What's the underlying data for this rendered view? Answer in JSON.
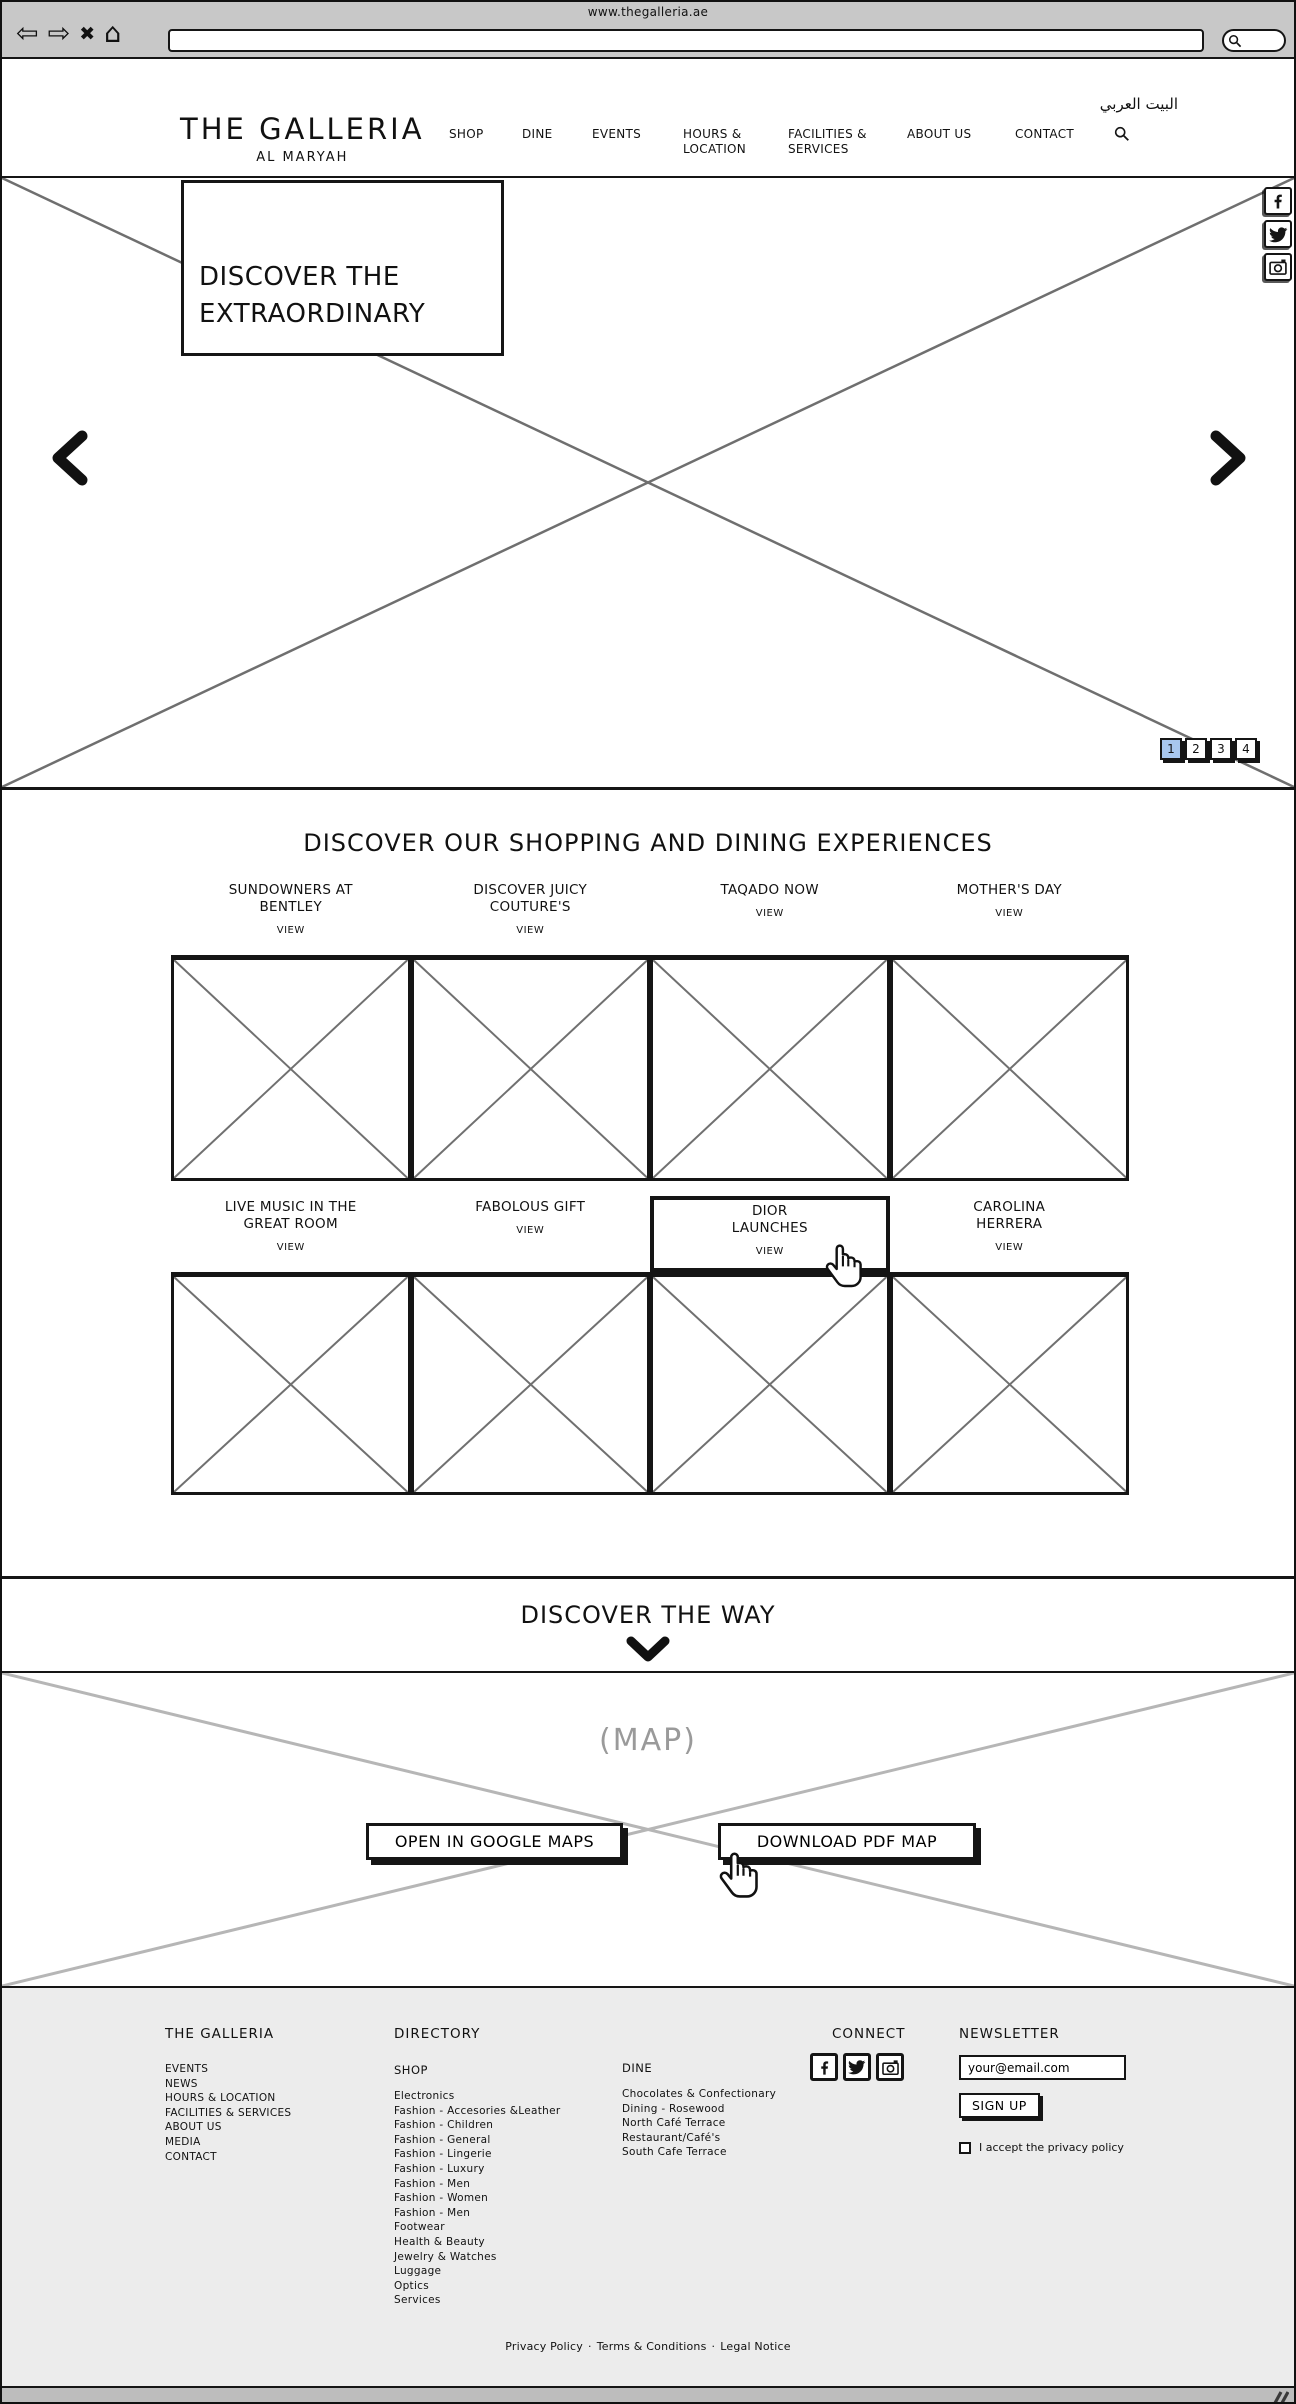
{
  "colors": {
    "wireframe_ink": "#151515",
    "chrome_bg": "#c8c8c8",
    "footer_bg": "#ececec",
    "active_page_bg": "#a8c7ee",
    "placeholder_line": "#6f6f6f",
    "map_line": "#b6b6b6",
    "map_label_gray": "#9a9a9a"
  },
  "browser": {
    "page_title": "www.thegalleria.ae",
    "url_value": "",
    "back_glyph": "⇦",
    "forward_glyph": "⇨",
    "close_glyph": "✖",
    "home_glyph": "⌂"
  },
  "header": {
    "logo": "THE GALLERIA",
    "logo_sub": "AL MARYAH",
    "language_link": "البيت العربي",
    "nav": [
      {
        "lines": [
          "SHOP"
        ]
      },
      {
        "lines": [
          "DINE"
        ]
      },
      {
        "lines": [
          "EVENTS"
        ]
      },
      {
        "lines": [
          "HOURS &",
          "LOCATION"
        ]
      },
      {
        "lines": [
          "FACILITIES &",
          "SERVICES"
        ]
      },
      {
        "lines": [
          "ABOUT US"
        ]
      },
      {
        "lines": [
          "CONTACT"
        ]
      }
    ]
  },
  "hero": {
    "headline_lines": [
      "DISCOVER THE",
      "EXTRAORDINARY"
    ],
    "pagination": [
      "1",
      "2",
      "3",
      "4"
    ],
    "active_page": "1"
  },
  "experiences": {
    "title": "DISCOVER OUR SHOPPING AND DINING EXPERIENCES",
    "view_label": "VIEW",
    "cards": [
      {
        "lines": [
          "SUNDOWNERS AT",
          "BENTLEY"
        ]
      },
      {
        "lines": [
          "DISCOVER JUICY",
          "COUTURE'S"
        ]
      },
      {
        "lines": [
          "TAQADO NOW",
          ""
        ]
      },
      {
        "lines": [
          "MOTHER'S DAY",
          ""
        ]
      },
      {
        "lines": [
          "LIVE MUSIC IN THE",
          "GREAT ROOM"
        ]
      },
      {
        "lines": [
          "FABOLOUS GIFT",
          ""
        ]
      },
      {
        "lines": [
          "DIOR",
          "LAUNCHES"
        ],
        "state": "hovered"
      },
      {
        "lines": [
          "CAROLINA",
          "HERRERA"
        ]
      }
    ]
  },
  "way": {
    "title": "DISCOVER THE WAY"
  },
  "map": {
    "placeholder_label": "(MAP)",
    "google_maps_button": "OPEN IN GOOGLE MAPS",
    "pdf_button": "DOWNLOAD PDF MAP"
  },
  "footer": {
    "galleria": {
      "heading": "THE GALLERIA",
      "links": [
        "EVENTS",
        "NEWS",
        "HOURS & LOCATION",
        "FACILITIES & SERVICES",
        "ABOUT US",
        "MEDIA",
        "CONTACT"
      ]
    },
    "directory": {
      "heading": "DIRECTORY",
      "shop": {
        "heading": "SHOP",
        "links": [
          "Electronics",
          "Fashion - Accesories &Leather",
          "Fashion - Children",
          "Fashion - General",
          "Fashion - Lingerie",
          "Fashion - Luxury",
          "Fashion - Men",
          "Fashion - Women",
          "Fashion - Men",
          "Footwear",
          "Health & Beauty",
          "Jewelry & Watches",
          "Luggage",
          "Optics",
          "Services"
        ]
      },
      "dine": {
        "heading": "DINE",
        "links": [
          "Chocolates & Confectionary",
          "Dining - Rosewood",
          "North Café Terrace",
          "Restaurant/Café's",
          "South Cafe Terrace"
        ]
      }
    },
    "connect": {
      "heading": "CONNECT"
    },
    "newsletter": {
      "heading": "NEWSLETTER",
      "email_value": "your@email.com",
      "signup_label": "SIGN UP",
      "privacy_label": "I accept the privacy policy",
      "privacy_checked": false
    },
    "legal_links": [
      "Privacy Policy",
      "Terms & Conditions",
      "Legal Notice"
    ],
    "legal_separator": "·"
  }
}
